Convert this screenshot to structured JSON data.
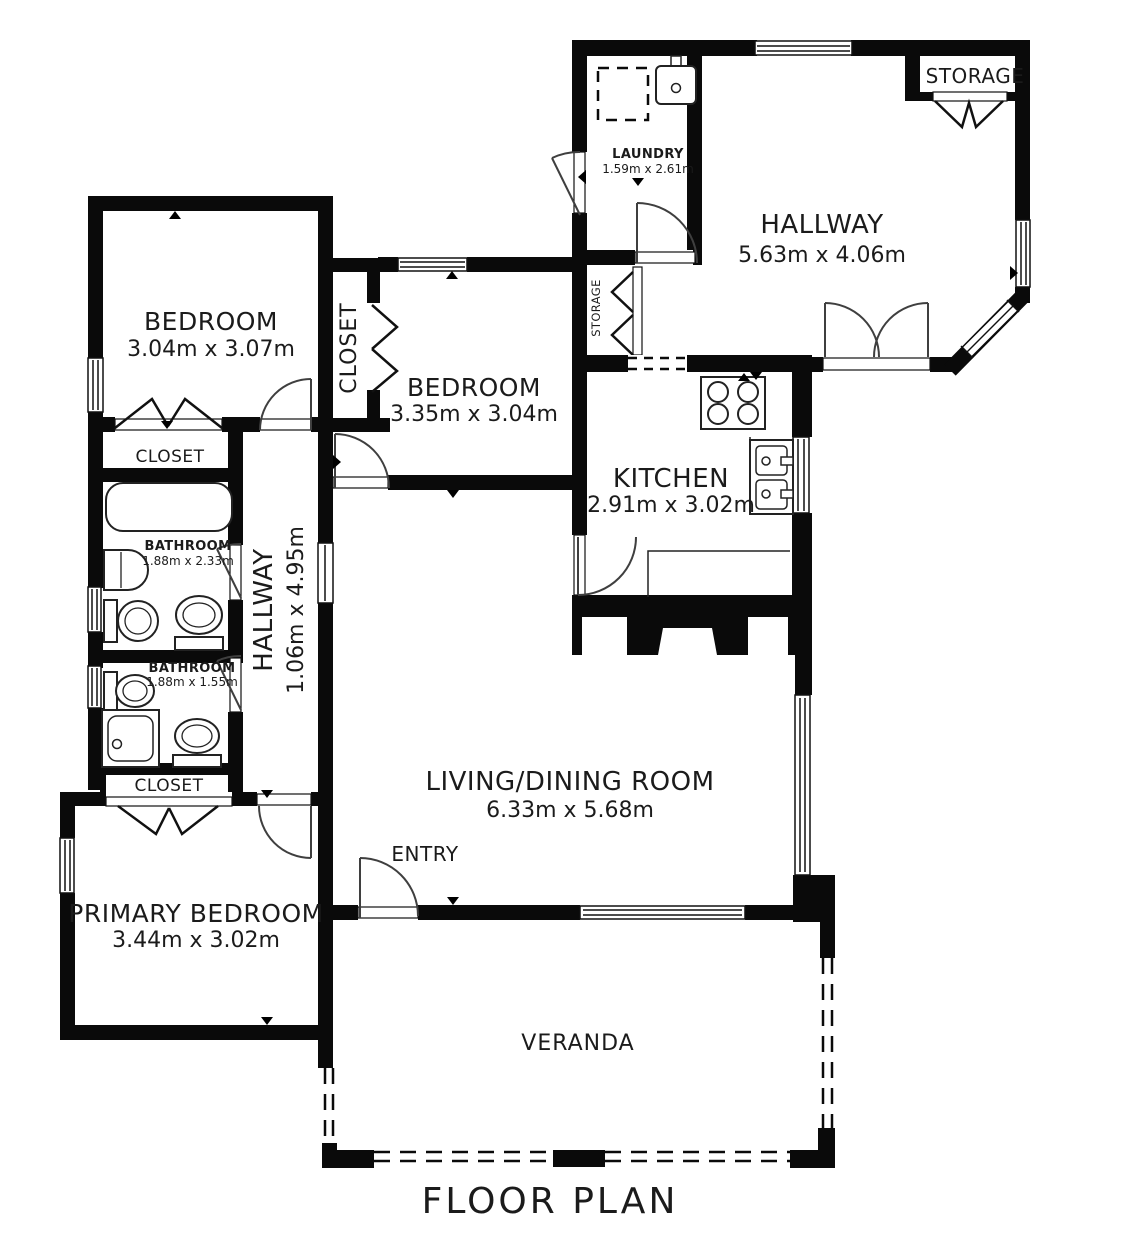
{
  "title": "FLOOR PLAN",
  "rooms": {
    "bedroom_1": {
      "label": "BEDROOM",
      "dims": "3.04m x 3.07m"
    },
    "bedroom_2": {
      "label": "BEDROOM",
      "dims": "3.35m x 3.04m"
    },
    "primary_bedroom": {
      "label": "PRIMARY BEDROOM",
      "dims": "3.44m x 3.02m"
    },
    "living_dining": {
      "label": "LIVING/DINING ROOM",
      "dims": "6.33m x 5.68m"
    },
    "kitchen": {
      "label": "KITCHEN",
      "dims": "2.91m x 3.02m"
    },
    "hallway_main": {
      "label": "HALLWAY",
      "dims": "5.63m x 4.06m"
    },
    "hallway_bedrooms": {
      "label": "HALLWAY",
      "dims": "1.06m x 4.95m"
    },
    "laundry": {
      "label": "LAUNDRY",
      "dims": "1.59m x 2.61m"
    },
    "bathroom_main": {
      "label": "BATHROOM",
      "dims": "1.88m x 2.33m"
    },
    "bathroom_second": {
      "label": "BATHROOM",
      "dims": "1.88m x 1.55m"
    },
    "storage_hallway": {
      "label": "STORAGE"
    },
    "storage_small": {
      "label": "STORAGE"
    },
    "closet_bedroom2": {
      "label": "CLOSET"
    },
    "closet_bathroom": {
      "label": "CLOSET"
    },
    "closet_primary": {
      "label": "CLOSET"
    },
    "entry": {
      "label": "ENTRY"
    },
    "veranda": {
      "label": "VERANDA"
    }
  },
  "colors": {
    "walls": "#0a0a0a",
    "background": "#ffffff",
    "lines": "#3f3f3f",
    "text": "#1b1b1b"
  }
}
